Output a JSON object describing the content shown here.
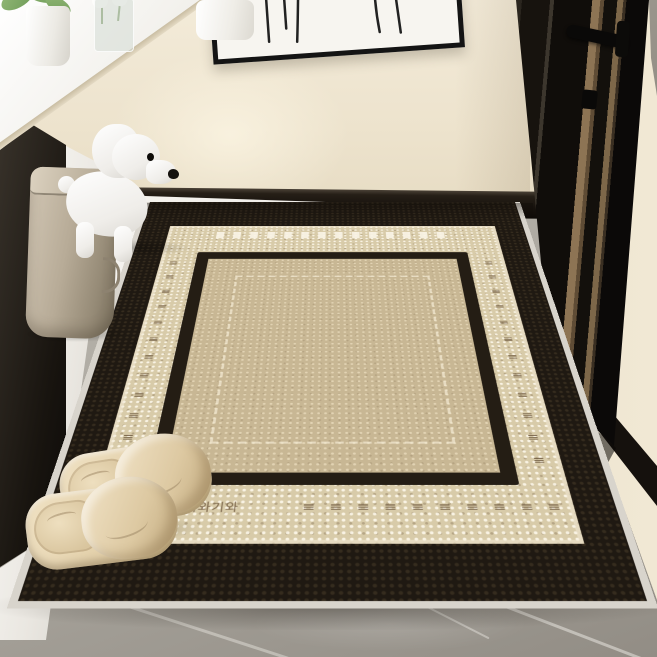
{
  "scene": {
    "type": "entryway product photo with bordered door mat",
    "wall_color": "#efe6d2",
    "floor_color": "#a7a29a",
    "baseboard_color": "#17120d"
  },
  "artwork": {
    "canvas_color": "#f7f5f0",
    "frame_color": "#141414",
    "subject": "abstract line-drawn figures"
  },
  "door": {
    "color": "#15110c",
    "stripe_color": "#8a7254",
    "handle_color": "#0b0a08",
    "frame_strip_color": "#8f8a80"
  },
  "shelf": {
    "panel_color": "#f4f2ed",
    "dark_side_color": "#221d18",
    "edge_trim_color": "#d9cfb8",
    "items": [
      "potted green plant",
      "white tulips in glass vase",
      "white canister"
    ]
  },
  "dog_figurine": {
    "body_color": "#f7f5f2",
    "eye_color": "#0d0b09",
    "nose_color": "#15120e"
  },
  "trash_bin": {
    "body_color": "#b3a895",
    "lid_color": "#cdc3b1"
  },
  "slippers": {
    "color": "#e4d2ae",
    "count": 2
  },
  "rug": {
    "brand_text": "기와기와",
    "binding_color": "#d8d4cc",
    "outer_border_color": "#201a13",
    "band_color": "#d8cba9",
    "inner_line_color": "#241d14",
    "field_color": "#c8b794",
    "dash_color": "#6f5a40",
    "rows": {
      "bottom_left": {
        "glyph": "≡",
        "count": 2
      },
      "bottom": {
        "glyph": "≡",
        "count": 12
      },
      "left": {
        "glyph": "≡",
        "count": 12
      },
      "right": {
        "glyph": "≡",
        "count": 12
      }
    }
  }
}
